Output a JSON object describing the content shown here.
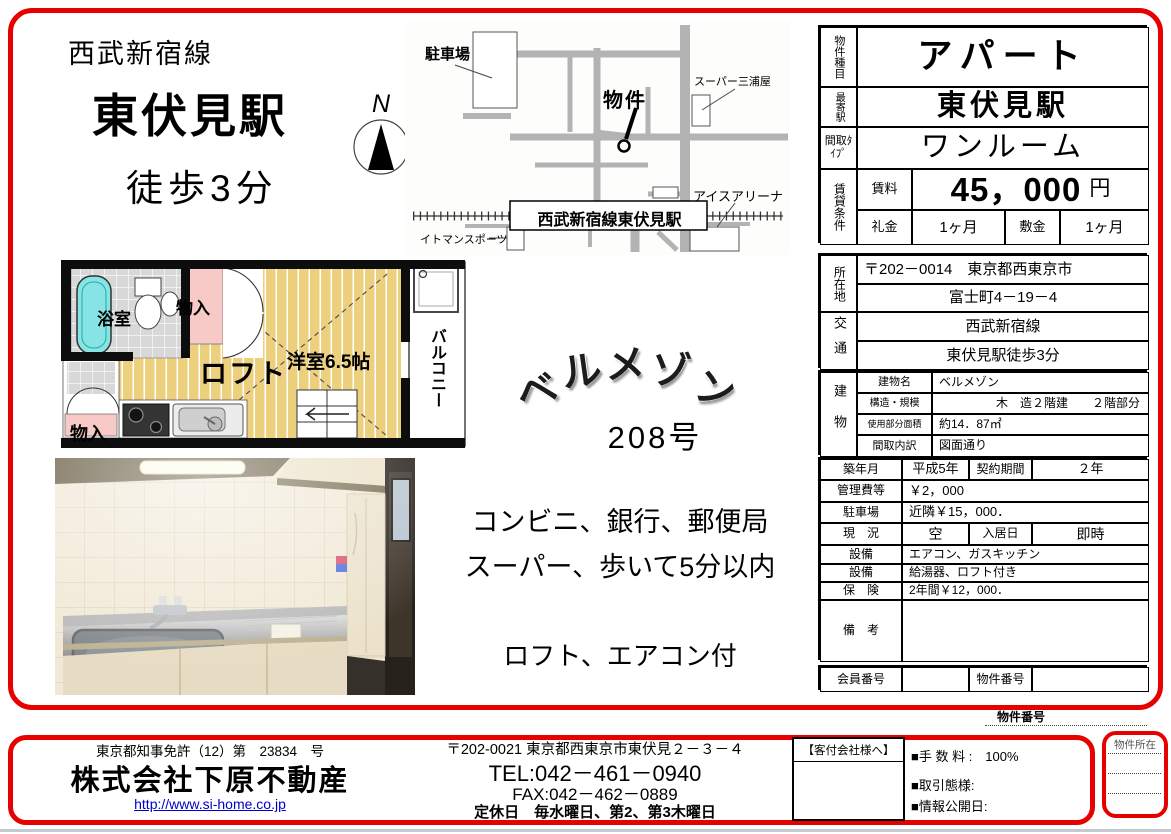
{
  "colors": {
    "accent_red": "#e60000",
    "link_blue": "#0000cc",
    "room_tan": "#ecd07e",
    "closet_pink": "#f7c9c7",
    "tub_cyan": "#86e4e4"
  },
  "header": {
    "line": "西武新宿線",
    "station": "東伏見駅",
    "walk": "徒歩3分",
    "compass_n": "N"
  },
  "map": {
    "parking": "駐車場",
    "supermarket": "スーパー三浦屋",
    "property": "物件",
    "station_sign": "西武新宿線東伏見駅",
    "ice_arena": "アイスアリーナ",
    "sports_club": "イトマンスポーツ"
  },
  "floorplan": {
    "bath": "浴室",
    "closet_top": "物入",
    "loft": "ロフト",
    "room": "洋室6.5帖",
    "balcony": "バルコニー",
    "closet_bottom": "物入"
  },
  "title": {
    "building_name": "ベルメゾン",
    "unit_no": "208号"
  },
  "notes": {
    "line1": "コンビニ、銀行、郵便局",
    "line2": "スーパー、歩いて5分以内",
    "line3": "ロフト、エアコン付"
  },
  "spec": {
    "property_type_label": "物件種目",
    "property_type": "アパート",
    "nearest_station_label": "最寄駅",
    "nearest_station": "東伏見駅",
    "layout_label": "間取ﾀｲﾌﾟ",
    "layout": "ワンルーム",
    "rental_label": "賃貸条件",
    "rent_label": "賃料",
    "rent": "45，000",
    "rent_unit": "円",
    "key_money_label": "礼金",
    "key_money": "1ヶ月",
    "deposit_label": "敷金",
    "deposit": "1ヶ月",
    "address_label": "所在地",
    "address1": "〒202－0014　東京都西東京市",
    "address2": "富士町4－19－4",
    "access_label": "交通",
    "access1": "西武新宿線",
    "access2": "東伏見駅徒歩3分",
    "building_label": "建物",
    "building_name_label": "建物名",
    "building_name": "ベルメゾン",
    "structure_label": "構造・規模",
    "structure": "木　造２階建　　２階部分",
    "area_label": "使用部分面積",
    "area": "約14．87㎡",
    "layout_detail_label": "間取内訳",
    "layout_detail": "図面通り",
    "built_label": "築年月",
    "built": "平成5年",
    "contract_label": "契約期間",
    "contract": "２年",
    "mgmt_label": "管理費等",
    "mgmt": "￥2，000",
    "parking_label": "駐車場",
    "parking": "近隣￥15，000．",
    "status_label": "現　況",
    "status": "空",
    "movein_label": "入居日",
    "movein": "即時",
    "equip1_label": "設備",
    "equip1": "エアコン、ガスキッチン",
    "equip2_label": "設備",
    "equip2": "給湯器、ロフト付き",
    "insurance_label": "保　険",
    "insurance": "2年間￥12，000．",
    "remarks_label": "備　考",
    "remarks": "",
    "member_no_label": "会員番号",
    "member_no": "",
    "property_no_label": "物件番号",
    "property_no": ""
  },
  "side": {
    "property_no_label": "物件番号",
    "property_loc_label": "物件所在"
  },
  "footer": {
    "license": "東京都知事免許（12）第　23834　号",
    "company": "株式会社下原不動産",
    "url": "http://www.si-home.co.jp",
    "address": "〒202-0021 東京都西東京市東伏見２－３－４",
    "tel": "TEL:042－461－0940",
    "fax": "FAX:042－462－0889",
    "closed": "定休日　毎水曜日、第2、第3木曜日",
    "agent_heading": "【客付会社様へ】",
    "fee": "■手 数 料 :　100%",
    "deal_type": "■取引態様:",
    "publish_date": "■情報公開日:"
  }
}
